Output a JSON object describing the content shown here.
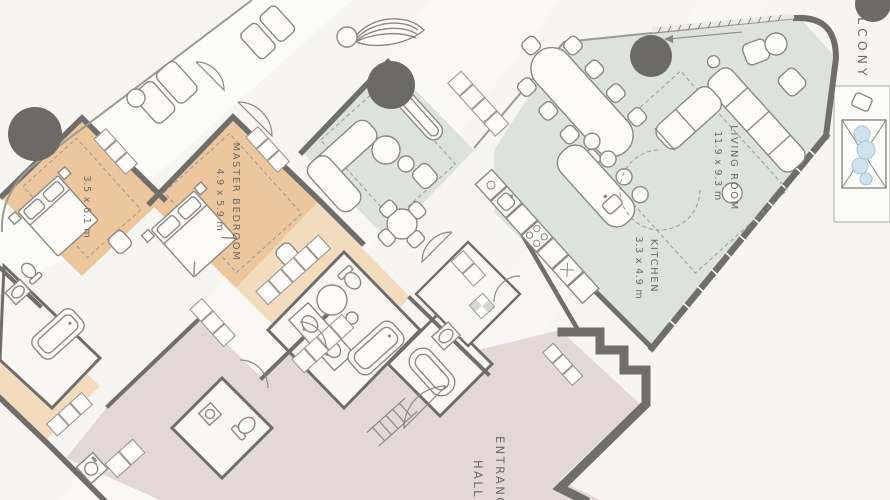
{
  "floor_plan": {
    "labels": {
      "master_bedroom": {
        "name": "MASTER BEDROOM",
        "dims": "4.9 x 5.9 m"
      },
      "bedroom_2": {
        "dims": "3.5 x 6.1 m"
      },
      "living_room": {
        "name": "LIVING ROOM",
        "dims": "11.9 x 9.3 m"
      },
      "kitchen": {
        "name": "KITCHEN",
        "dims": "3.3 x 4.9 m"
      },
      "balcony": {
        "name": "BALCONY"
      },
      "entrance_hall": {
        "name": "ENTRANCE HALL",
        "line1": "ENTRANCE",
        "line2": "HALL"
      }
    },
    "colors": {
      "background": "#f6f5f2",
      "bedroom_zone": "#ecc79e",
      "bedroom_zone_light": "#f3dcbe",
      "living_zone": "#dbe3da",
      "hall_zone": "#e3d8d6",
      "bath_floor": "#f8f7f4",
      "balcony_floor": "#fbfbf9",
      "wall": "#6f6e6a",
      "column": "#6b6a66",
      "water": "#cfe2ee",
      "label_text": "#6c6b64"
    }
  }
}
